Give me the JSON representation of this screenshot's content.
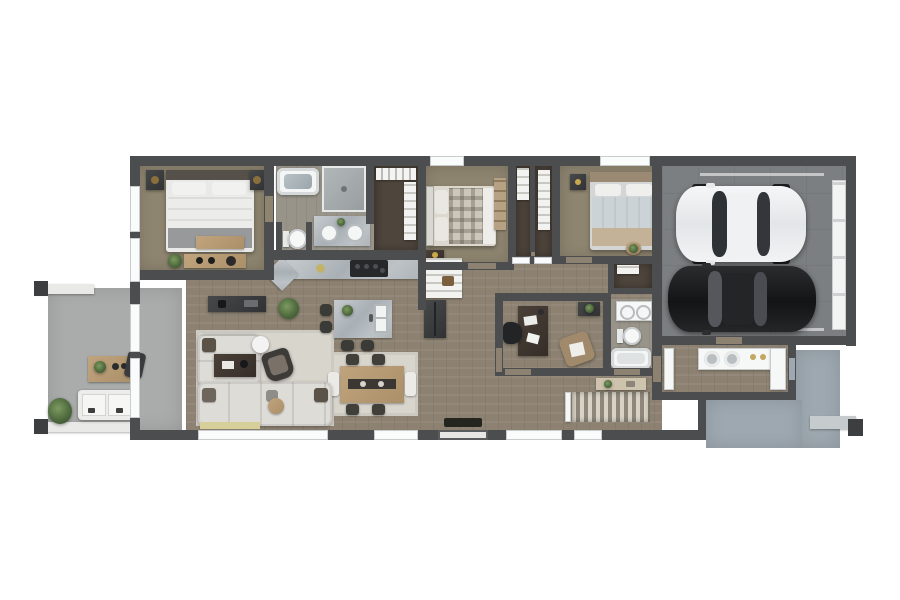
{
  "scene": {
    "kind": "3d-floor-plan-rendering",
    "style": "top-down dollhouse view, single-story home with attached 2-car garage",
    "background": "#ffffff"
  },
  "palette": {
    "wall": "#4b4d4f",
    "carpet": "#8e8570",
    "wood": "#8d8272",
    "bathfloor": "#98948a",
    "closetfloor": "#4e453c",
    "garage": "#7c7f81",
    "concrete": "#a9acab",
    "concreteblue": "#9ea8b0",
    "rug": "#d8d5cd",
    "sofa": "#dedcd7",
    "marble": "#b7bdc2",
    "tan": "#b49a74",
    "darkfurniture": "#3a3c3e",
    "plantgreen": "#5d7a4a",
    "carwhite": "#eef0f1",
    "carblack": "#1e2022",
    "accentmat": "#d6cf9a"
  },
  "rooms": [
    {
      "id": "master-bedroom",
      "features": [
        "double-bed",
        "nightstands",
        "bench",
        "dresser",
        "windows"
      ]
    },
    {
      "id": "master-bathroom",
      "features": [
        "bathtub",
        "shower",
        "double-vanity",
        "water-closet-toilet"
      ]
    },
    {
      "id": "walk-in-closet",
      "features": [
        "hanging-rail",
        "shelving"
      ]
    },
    {
      "id": "bedroom-2",
      "features": [
        "plaid-bed",
        "nightstand",
        "shelf-unit",
        "window"
      ]
    },
    {
      "id": "hall-closets",
      "features": [
        "two-compartments",
        "shelving",
        "sliding-doors"
      ]
    },
    {
      "id": "bedroom-3",
      "features": [
        "double-bed",
        "nightstand",
        "plant-stand",
        "window"
      ]
    },
    {
      "id": "linen-closet",
      "features": [
        "shelf"
      ]
    },
    {
      "id": "kitchen",
      "features": [
        "counter-run",
        "range",
        "island-with-sink",
        "bar-stools",
        "refrigerator",
        "pantry"
      ]
    },
    {
      "id": "dining-area",
      "features": [
        "table-for-six",
        "area-rug"
      ]
    },
    {
      "id": "living-room",
      "features": [
        "sectional-sofa",
        "coffee-table",
        "accent-chair",
        "floor-lamp",
        "media-console",
        "area-rug",
        "plants"
      ]
    },
    {
      "id": "office",
      "features": [
        "desk",
        "task-chair",
        "armchair",
        "dresser"
      ]
    },
    {
      "id": "bathroom-2",
      "features": [
        "double-vanity",
        "toilet",
        "bathtub"
      ]
    },
    {
      "id": "entry-hall",
      "features": [
        "front-door",
        "doormat",
        "console-table",
        "slatted-stair-feature"
      ]
    },
    {
      "id": "mudroom-laundry",
      "features": [
        "washer",
        "dryer",
        "cabinets",
        "counter"
      ]
    },
    {
      "id": "two-car-garage",
      "features": [
        "white-sedan",
        "black-sedan",
        "garage-door"
      ]
    },
    {
      "id": "covered-patio-left",
      "features": [
        "pergola-beams",
        "coffee-table",
        "lounge-chair",
        "loveseat",
        "potted-plant"
      ]
    },
    {
      "id": "rear-patio",
      "features": [
        "concrete-slab",
        "beam",
        "post"
      ]
    }
  ],
  "vehicles": [
    {
      "name": "white-sedan",
      "color": "#eef0f1",
      "orientation": "facing-left"
    },
    {
      "name": "black-sedan",
      "color": "#1e2022",
      "orientation": "facing-left"
    }
  ]
}
